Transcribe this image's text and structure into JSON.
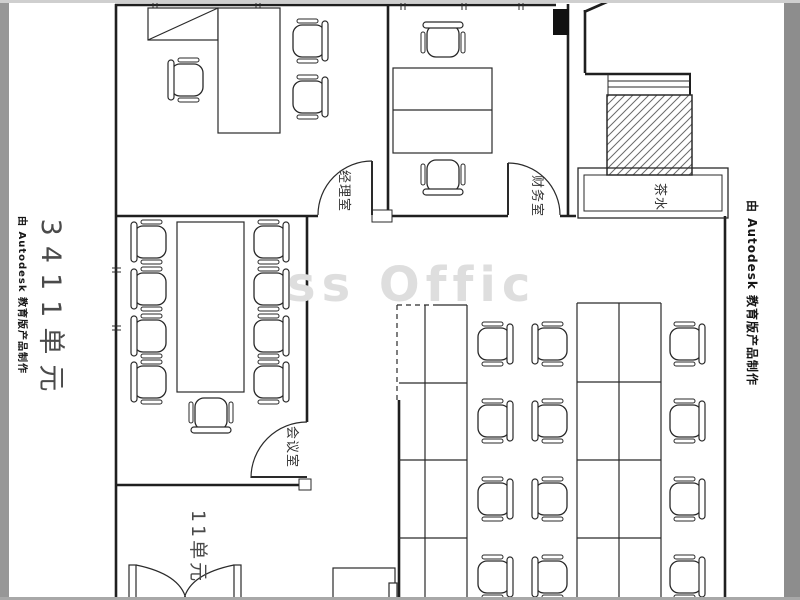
{
  "watermarks": {
    "autodesk": "由 Autodesk 教育版产品制作",
    "center_fragment": "ss Offic"
  },
  "unit_labels": {
    "main": "3411单元",
    "entry": "11单元"
  },
  "room_labels": {
    "manager": "经理室",
    "finance": "财务室",
    "meeting": "会议室",
    "tea": "茶水"
  },
  "colors": {
    "wall_line": "#1f1f1f",
    "furniture_line": "#2a2a2a",
    "left_border": "#979797",
    "right_border": "#8d8d8d",
    "hatch_line": "#6a6a6a",
    "center_watermark": "#dedede",
    "label_text": "#4a4a4a"
  }
}
